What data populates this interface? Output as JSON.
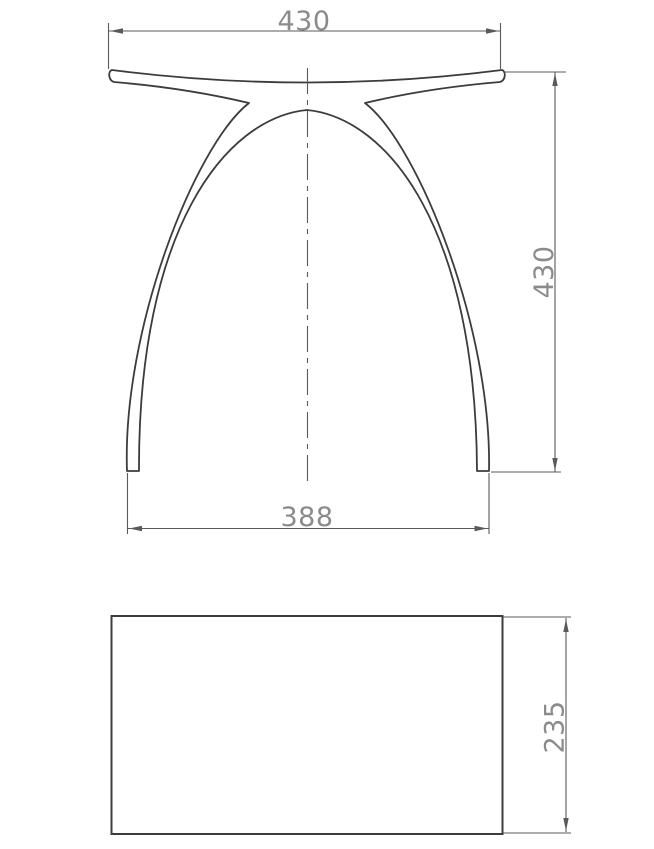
{
  "front_view": {
    "seat_width": "430",
    "overall_height": "430",
    "base_width": "388"
  },
  "plan_view": {
    "depth": "235"
  },
  "colors": {
    "outline": "#3c3c3c",
    "dimension": "#5a5a5a",
    "text": "#8b8b8b",
    "background": "#ffffff"
  }
}
